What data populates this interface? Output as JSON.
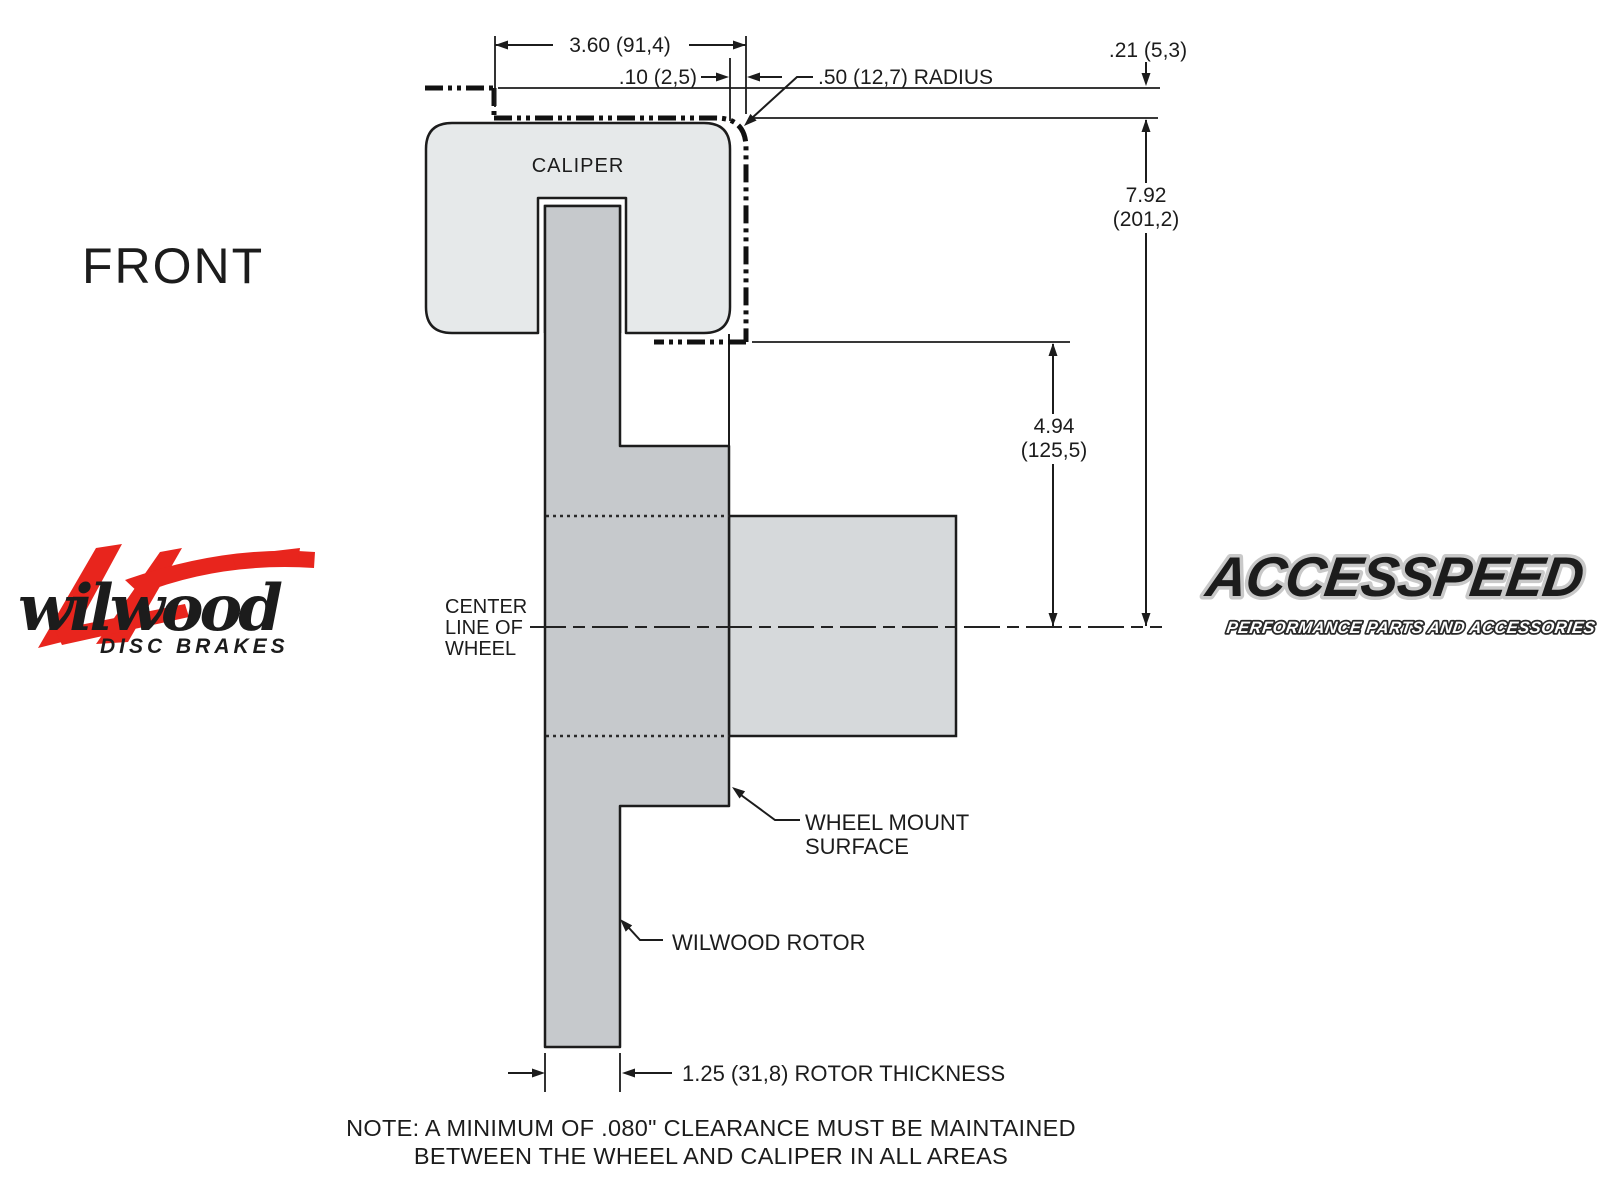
{
  "colors": {
    "background": "#ffffff",
    "line": "#1c1c1c",
    "caliper_fill": "#e6e9ea",
    "rotor_fill": "#c6c9cc",
    "hub_fill": "#d6d9db",
    "wilwood_red": "#e8251d",
    "logo_black": "#141414"
  },
  "view_label": "FRONT",
  "diagram": {
    "caliper_label": "CALIPER",
    "centerline_label": {
      "line1": "CENTER",
      "line2": "LINE OF",
      "line3": "WHEEL"
    },
    "wheel_mount_label": {
      "line1": "WHEEL MOUNT",
      "line2": "SURFACE"
    },
    "rotor_label": "WILWOOD ROTOR",
    "dimensions": {
      "caliper_width": "3.60 (91,4)",
      "wheel_clearance": ".10 (2,5)",
      "corner_radius": ".50 (12,7) RADIUS",
      "lip_depth": ".21 (5,3)",
      "wheel_inner_depth": {
        "line1": "7.92",
        "line2": "(201,2)"
      },
      "mount_to_lip": {
        "line1": "4.94",
        "line2": "(125,5)"
      },
      "rotor_thickness": "1.25 (31,8) ROTOR THICKNESS"
    },
    "note": {
      "line1": "NOTE: A MINIMUM OF .080\" CLEARANCE MUST BE MAINTAINED",
      "line2": "BETWEEN THE WHEEL AND CALIPER IN ALL AREAS"
    }
  },
  "logos": {
    "wilwood": {
      "name": "wilwood",
      "tagline": "DISC BRAKES"
    },
    "accesspeed": {
      "name": "ACCESSPEED",
      "tagline": "PERFORMANCE PARTS AND ACCESSORIES"
    }
  }
}
